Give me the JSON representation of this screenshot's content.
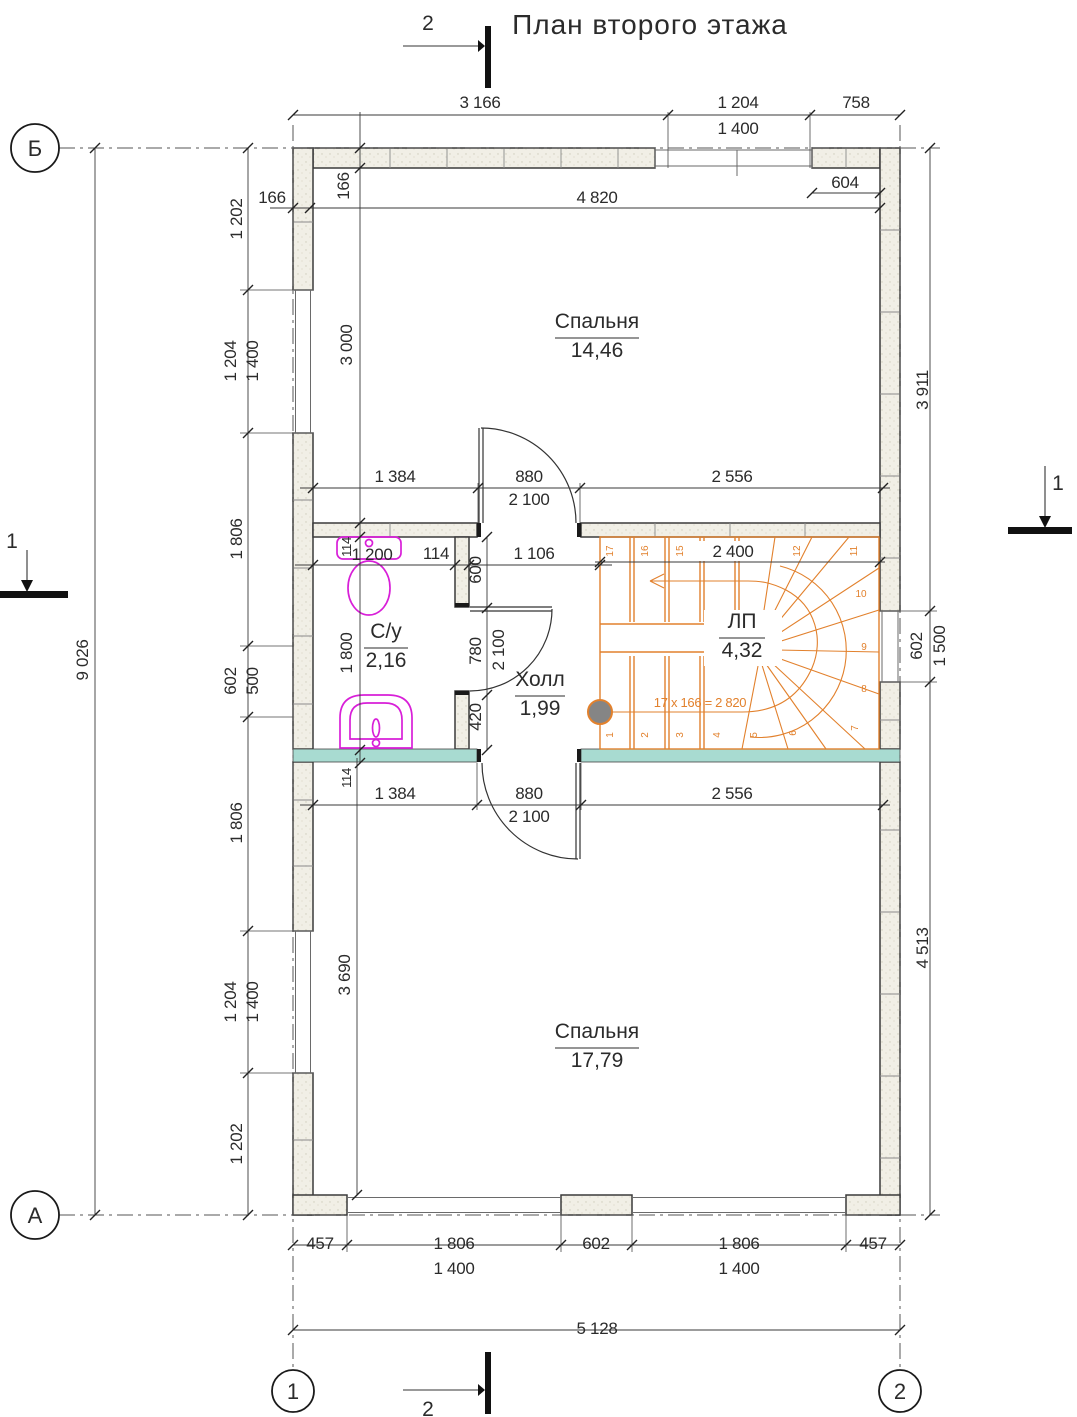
{
  "title": {
    "text": "План второго этажа"
  },
  "colors": {
    "accent_orange": "#e2812d",
    "fixture_magenta": "#d81fd8",
    "slab_teal": "#a8dbd1",
    "wall_fill": "#f1efe6",
    "line": "#333333"
  },
  "axis_markers": [
    {
      "label": "Б",
      "x": 35,
      "y": 148,
      "r": 24
    },
    {
      "label": "А",
      "x": 35,
      "y": 1215,
      "r": 24
    },
    {
      "label": "1",
      "x": 293,
      "y": 1391,
      "r": 21
    },
    {
      "label": "2",
      "x": 900,
      "y": 1391,
      "r": 21
    }
  ],
  "section_markers": [
    {
      "label": "2"
    },
    {
      "label": "2"
    },
    {
      "label": "1"
    },
    {
      "label": "1"
    }
  ],
  "rooms": [
    {
      "name": "Спальня",
      "area": "14,46",
      "x": 597,
      "y": 328,
      "w": 84
    },
    {
      "name": "Спальня",
      "area": "17,79",
      "x": 597,
      "y": 1038,
      "w": 84
    },
    {
      "name": "С/у",
      "area": "2,16",
      "x": 386,
      "y": 638,
      "w": 44
    },
    {
      "name": "Холл",
      "area": "1,99",
      "x": 540,
      "y": 686,
      "w": 50
    },
    {
      "name": "ЛП",
      "area": "4,32",
      "x": 742,
      "y": 628,
      "w": 46
    }
  ],
  "dimensions": [
    {
      "t": "3 166",
      "x": 480,
      "y": 108
    },
    {
      "t": "1 204",
      "x": 738,
      "y": 108
    },
    {
      "t": "758",
      "x": 856,
      "y": 108
    },
    {
      "t": "1 400",
      "x": 738,
      "y": 134
    },
    {
      "t": "166",
      "x": 272,
      "y": 203
    },
    {
      "t": "604",
      "x": 845,
      "y": 188
    },
    {
      "t": "4 820",
      "x": 597,
      "y": 203
    },
    {
      "t": "1 384",
      "x": 395,
      "y": 482
    },
    {
      "t": "880",
      "x": 529,
      "y": 482
    },
    {
      "t": "2 100",
      "x": 529,
      "y": 505
    },
    {
      "t": "2 556",
      "x": 732,
      "y": 482
    },
    {
      "t": "2 400",
      "x": 733,
      "y": 557
    },
    {
      "t": "114",
      "x": 436,
      "y": 559
    },
    {
      "t": "1 200",
      "x": 372,
      "y": 560
    },
    {
      "t": "1 106",
      "x": 534,
      "y": 559
    },
    {
      "t": "1 384",
      "x": 395,
      "y": 799
    },
    {
      "t": "880",
      "x": 529,
      "y": 799
    },
    {
      "t": "2 100",
      "x": 529,
      "y": 822
    },
    {
      "t": "2 556",
      "x": 732,
      "y": 799
    },
    {
      "t": "457",
      "x": 320,
      "y": 1249
    },
    {
      "t": "1 806",
      "x": 454,
      "y": 1249
    },
    {
      "t": "602",
      "x": 596,
      "y": 1249
    },
    {
      "t": "1 806",
      "x": 739,
      "y": 1249
    },
    {
      "t": "457",
      "x": 873,
      "y": 1249
    },
    {
      "t": "1 400",
      "x": 454,
      "y": 1274
    },
    {
      "t": "1 400",
      "x": 739,
      "y": 1274
    },
    {
      "t": "5 128",
      "x": 597,
      "y": 1334
    },
    {
      "t": "166",
      "x": 349,
      "y": 186,
      "r": -90
    },
    {
      "t": "1 202",
      "x": 242,
      "y": 219,
      "r": -90
    },
    {
      "t": "1 204",
      "x": 236,
      "y": 361,
      "r": -90
    },
    {
      "t": "1 400",
      "x": 258,
      "y": 361,
      "r": -90
    },
    {
      "t": "1 806",
      "x": 242,
      "y": 539,
      "r": -90
    },
    {
      "t": "602",
      "x": 236,
      "y": 681,
      "r": -90
    },
    {
      "t": "500",
      "x": 258,
      "y": 681,
      "r": -90
    },
    {
      "t": "1 806",
      "x": 242,
      "y": 823,
      "r": -90
    },
    {
      "t": "1 204",
      "x": 236,
      "y": 1002,
      "r": -90
    },
    {
      "t": "1 400",
      "x": 258,
      "y": 1002,
      "r": -90
    },
    {
      "t": "1 202",
      "x": 242,
      "y": 1144,
      "r": -90
    },
    {
      "t": "9 026",
      "x": 88,
      "y": 660,
      "r": -90
    },
    {
      "t": "3 000",
      "x": 352,
      "y": 345,
      "r": -90
    },
    {
      "t": "114",
      "x": 351,
      "y": 547,
      "r": -90,
      "s": 1
    },
    {
      "t": "1 800",
      "x": 352,
      "y": 653,
      "r": -90
    },
    {
      "t": "114",
      "x": 351,
      "y": 778,
      "r": -90,
      "s": 1
    },
    {
      "t": "3 690",
      "x": 350,
      "y": 975,
      "r": -90
    },
    {
      "t": "600",
      "x": 481,
      "y": 570,
      "r": -90
    },
    {
      "t": "780",
      "x": 481,
      "y": 651,
      "r": -90
    },
    {
      "t": "2 100",
      "x": 504,
      "y": 650,
      "r": -90
    },
    {
      "t": "420",
      "x": 481,
      "y": 717,
      "r": -90
    },
    {
      "t": "3 911",
      "x": 928,
      "y": 390,
      "r": -90
    },
    {
      "t": "602",
      "x": 922,
      "y": 646,
      "r": -90
    },
    {
      "t": "1 500",
      "x": 945,
      "y": 646,
      "r": -90
    },
    {
      "t": "4 513",
      "x": 928,
      "y": 948,
      "r": -90
    },
    {
      "t": "17 x 166 = 2 820",
      "x": 700,
      "y": 707,
      "c": "o",
      "s": 2
    }
  ],
  "stair": {
    "name": "ЛП",
    "area": "4,32",
    "formula": "17 x 166 = 2 820",
    "width_dim": "2 400",
    "steps": [
      {
        "n": "17",
        "x": 613,
        "y": 551,
        "r": -90
      },
      {
        "n": "16",
        "x": 648,
        "y": 551,
        "r": -90
      },
      {
        "n": "15",
        "x": 683,
        "y": 551,
        "r": -90
      },
      {
        "n": "14",
        "x": 718,
        "y": 551,
        "r": -90
      },
      {
        "n": "12",
        "x": 800,
        "y": 551,
        "r": -90
      },
      {
        "n": "11",
        "x": 857,
        "y": 551,
        "r": -90
      },
      {
        "n": "10",
        "x": 861,
        "y": 597,
        "r": 0
      },
      {
        "n": "9",
        "x": 864,
        "y": 650,
        "r": 0
      },
      {
        "n": "8",
        "x": 864,
        "y": 692,
        "r": 0
      },
      {
        "n": "7",
        "x": 858,
        "y": 728,
        "r": -90
      },
      {
        "n": "1",
        "x": 613,
        "y": 735,
        "r": -90
      },
      {
        "n": "2",
        "x": 648,
        "y": 735,
        "r": -90
      },
      {
        "n": "3",
        "x": 683,
        "y": 735,
        "r": -90
      },
      {
        "n": "4",
        "x": 720,
        "y": 735,
        "r": -90
      },
      {
        "n": "5",
        "x": 757,
        "y": 735,
        "r": -90
      },
      {
        "n": "6",
        "x": 796,
        "y": 733,
        "r": -90
      }
    ]
  }
}
